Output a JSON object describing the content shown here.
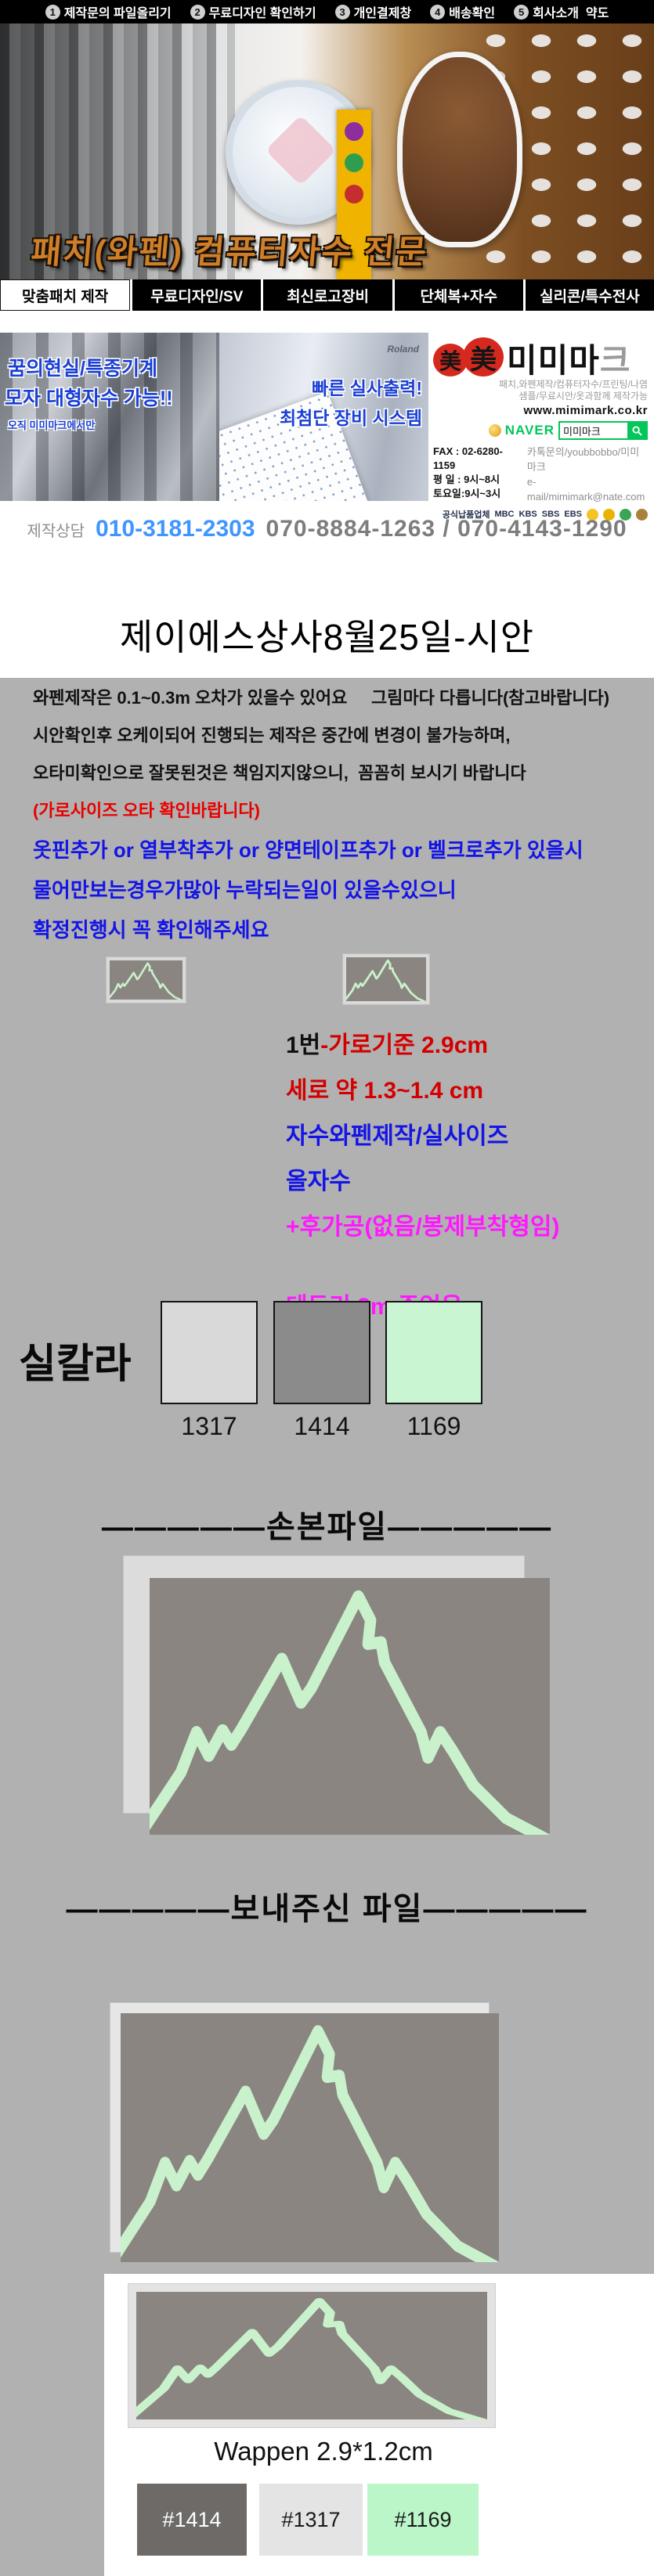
{
  "topbar": {
    "items": [
      {
        "num": "1",
        "label": "제작문의 파일올리기"
      },
      {
        "num": "2",
        "label": "무료디자인 확인하기"
      },
      {
        "num": "3",
        "label": "개인결제창"
      },
      {
        "num": "4",
        "label": "배송확인"
      },
      {
        "num": "5",
        "label": "회사소개  약도"
      }
    ]
  },
  "banner": {
    "headline": "패치(와펜) 컴퓨터자수 전문"
  },
  "tabs": [
    {
      "label": "맞춤패치 제작",
      "active": true
    },
    {
      "label": "무료디자인/SV",
      "active": false
    },
    {
      "label": "최신로고장비",
      "active": false
    },
    {
      "label": "단체복+자수",
      "active": false
    },
    {
      "label": "실리콘/특수전사",
      "active": false
    }
  ],
  "promo": {
    "left_line1": "꿈의현실/특종기계",
    "left_line2": "모자 대형자수 가능!!",
    "left_line3": "오직 미미마크에서만",
    "mid_brand": "Roland",
    "mid_line1": "빠른 실사출력!",
    "mid_line2": "최첨단 장비 시스템",
    "brand": {
      "logo_hanja1": "美",
      "logo_hanja2": "美",
      "name_black": "미미마",
      "name_gray": "크",
      "tagline1": "패치,와펜제작/컴퓨터자수/프린팅/나염",
      "tagline2": "샘플/무료시안/옷과함께 제작가능",
      "website": "www.mimimark.co.kr",
      "naver_label": "NAVER",
      "naver_query": "미미마크",
      "fax": "FAX : 02-6280-1159",
      "weekday": "평 일 : 9시~8시",
      "saturday": "토요일:9시~3시",
      "kakao": "카톡문의/youbbobbo/미미마크",
      "email": "e-mail/mimimark@nate.com",
      "broadcast_label": "공식납품업체",
      "broadcast_mbc": "MBC",
      "broadcast_kbs": "KBS",
      "broadcast_sbs": "SBS",
      "broadcast_ebs": "EBS"
    }
  },
  "contact": {
    "label": "제작상담",
    "mobile": "010-3181-2303",
    "landline": "070-8884-1263 / 070-4143-1290"
  },
  "title": "제이에스상사8월25일-시안",
  "notice": {
    "line1": "와펜제작은 0.1~0.3m 오차가 있을수 있어요     그림마다 다릅니다(참고바랍니다)",
    "line2": "시안확인후 오케이되어 진행되는 제작은 중간에 변경이 불가능하며,",
    "line3": "오타미확인으로 잘못된것은 책임지지않으니,  꼼꼼히 보시기 바랍니다",
    "line4": "(가로사이즈 오타 확인바랍니다)",
    "line5": "옷핀추가 or 열부착추가 or 양면테이프추가 or 벨크로추가 있을시",
    "line6": "물어만보는경우가많아 누락되는일이 있을수있으니",
    "line7": "확정진행시 꼭 확인해주세요"
  },
  "spec": {
    "no": "1번",
    "width": "-가로기준 2.9cm",
    "height": "세로 약 1.3~1.4 cm",
    "type": "자수와펜제작/실사이즈",
    "stitch": "올자수",
    "finish": "+후가공(없음/봉제부착형임)",
    "border": "테두리 2m 주었음"
  },
  "thread_colors": {
    "label": "실칼라",
    "swatches": [
      {
        "code": "1317",
        "hex": "#d9d9d9"
      },
      {
        "code": "1414",
        "hex": "#8b8b8b"
      },
      {
        "code": "1169",
        "hex": "#c9f5d3"
      }
    ]
  },
  "sections": {
    "draft": "—————손본파일—————",
    "received": "—————보내주신 파일—————"
  },
  "wappen": {
    "caption": "Wappen 2.9*1.2cm",
    "swatches": [
      {
        "code": "#1414",
        "hex": "#6e6a67",
        "text": "#ffffff"
      },
      {
        "code": "#1317",
        "hex": "#e4e4e4",
        "text": "#1a1a1a"
      },
      {
        "code": "#1169",
        "hex": "#baf6c8",
        "text": "#1a1a1a"
      }
    ]
  },
  "colors": {
    "mountain_line": "#c9f2cc",
    "patch_bg": "#8a8580",
    "sheet_gray": "#b1b1b1",
    "naver_green": "#03c75a",
    "logo_red": "#d5281e"
  }
}
